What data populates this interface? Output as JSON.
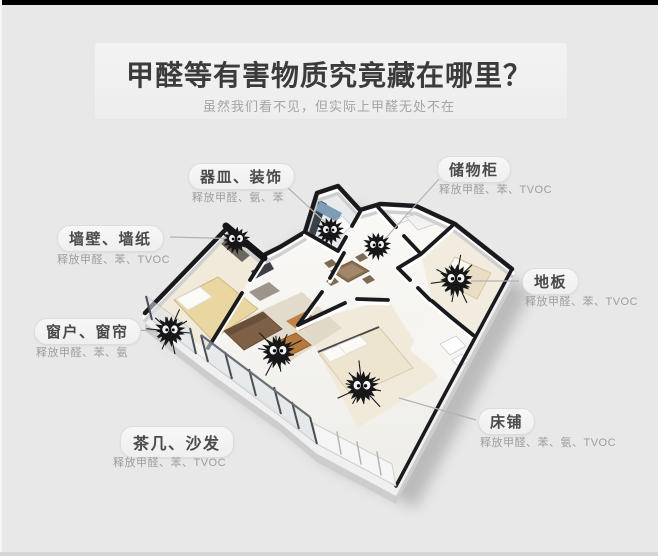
{
  "page": {
    "title": "甲醛等有害物质究竟藏在哪里？",
    "subtitle": "虽然我们看不见，但实际上甲醛无处不在"
  },
  "callouts": [
    {
      "label": "器皿、装饰",
      "sub": "释放甲醛、氨、苯"
    },
    {
      "label": "储物柜",
      "sub": "释放甲醛、苯、TVOC"
    },
    {
      "label": "墙壁、墙纸",
      "sub": "释放甲醛、苯、TVOC"
    },
    {
      "label": "地板",
      "sub": "释放甲醛、苯、TVOC"
    },
    {
      "label": "窗户、窗帘",
      "sub": "释放甲醛、苯、氨"
    },
    {
      "label": "茶几、沙发",
      "sub": "释放甲醛、苯、TVOC"
    },
    {
      "label": "床铺",
      "sub": "释放甲醛、苯、氨、TVOC"
    }
  ],
  "icons": {
    "soot_sprite": "fuzzy black formaldehyde monster with white eyes"
  },
  "colors": {
    "background": "#e8e8e8",
    "top_bar": "#000000",
    "title_text": "#3b3b3b",
    "subtitle_text": "#a5a5a5",
    "pill_bg": "#f3f3f3",
    "pill_text": "#4a4a4a",
    "sub_text": "#9d9d9d",
    "connector": "#b3b3b3",
    "wall_cap": "#1a1a1e",
    "sprite": "#17171a",
    "bed_blanket": "#e9d6a0",
    "sofa": "#7e6047",
    "coffee_table": "#b5793f",
    "kitchen_counter": "#39414a"
  }
}
